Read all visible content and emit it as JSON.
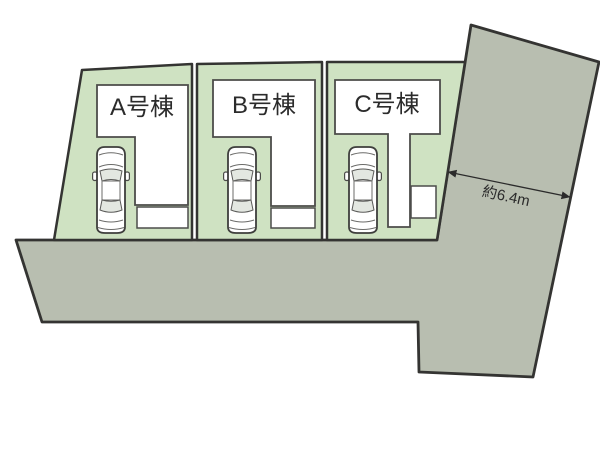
{
  "diagram": {
    "type": "site-plan",
    "lots": [
      {
        "id": "A",
        "label": "A号棟"
      },
      {
        "id": "B",
        "label": "B号棟"
      },
      {
        "id": "C",
        "label": "C号棟"
      }
    ],
    "dimension": {
      "label": "約6.4m"
    },
    "colors": {
      "background": "#ffffff",
      "lot_fill": "#cfe2c2",
      "road_fill": "#b8beb0",
      "building_fill": "#ffffff",
      "outline": "#343432",
      "building_outline": "#4c4c4a",
      "label_text": "#2b2b2b",
      "glass_fill": "#e3e7e1"
    }
  }
}
